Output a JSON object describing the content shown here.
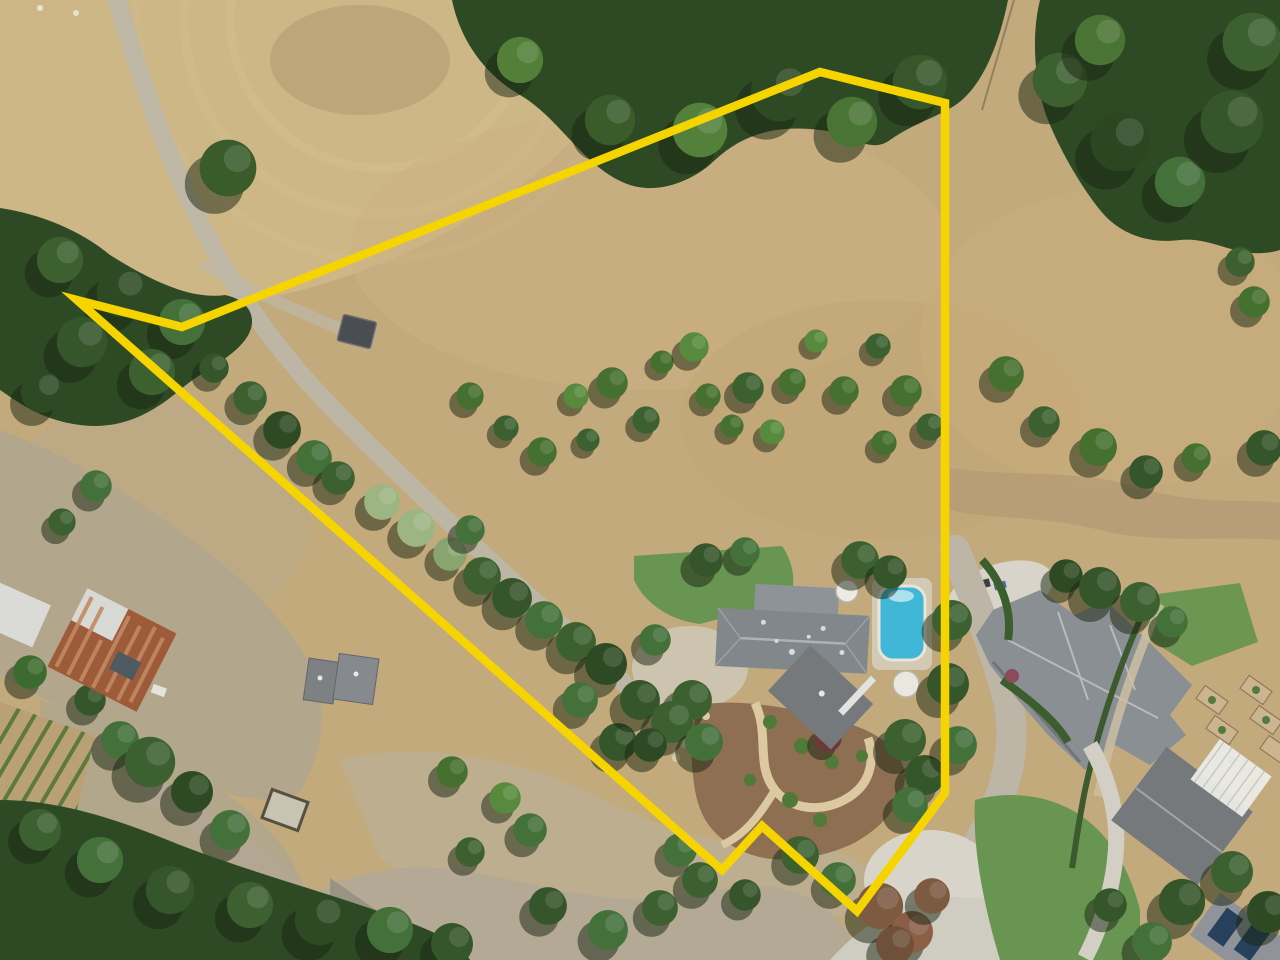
{
  "scene": {
    "kind": "aerial-drone-photo",
    "subject": "rural property parcel outlined in yellow with farmhouse, pool, orchard, barns, vineyard and neighboring estate"
  },
  "boundary": {
    "color": "#f5d400",
    "stroke_width": 8.5,
    "points": "820,72 945,103 945,793 857,911 762,826 722,870 77,300 182,327"
  },
  "palette": {
    "boundaryColor": "#f5d400",
    "dryGrass": "#c3aa7d",
    "dryGrassLight": "#cfb888",
    "dirtYard": "#b1a68d",
    "road": "#bdb6a7",
    "concrete": "#d8d4c9",
    "forest": "#2e4a24",
    "treeGreen": "#45702f",
    "lawn": "#689551",
    "pool": "#41b7d8",
    "roof": "#82878c",
    "roofDark": "#75797c",
    "mulch": "#8a6a4e",
    "rust": "#9e5b3a",
    "vine": "#4d7233"
  }
}
